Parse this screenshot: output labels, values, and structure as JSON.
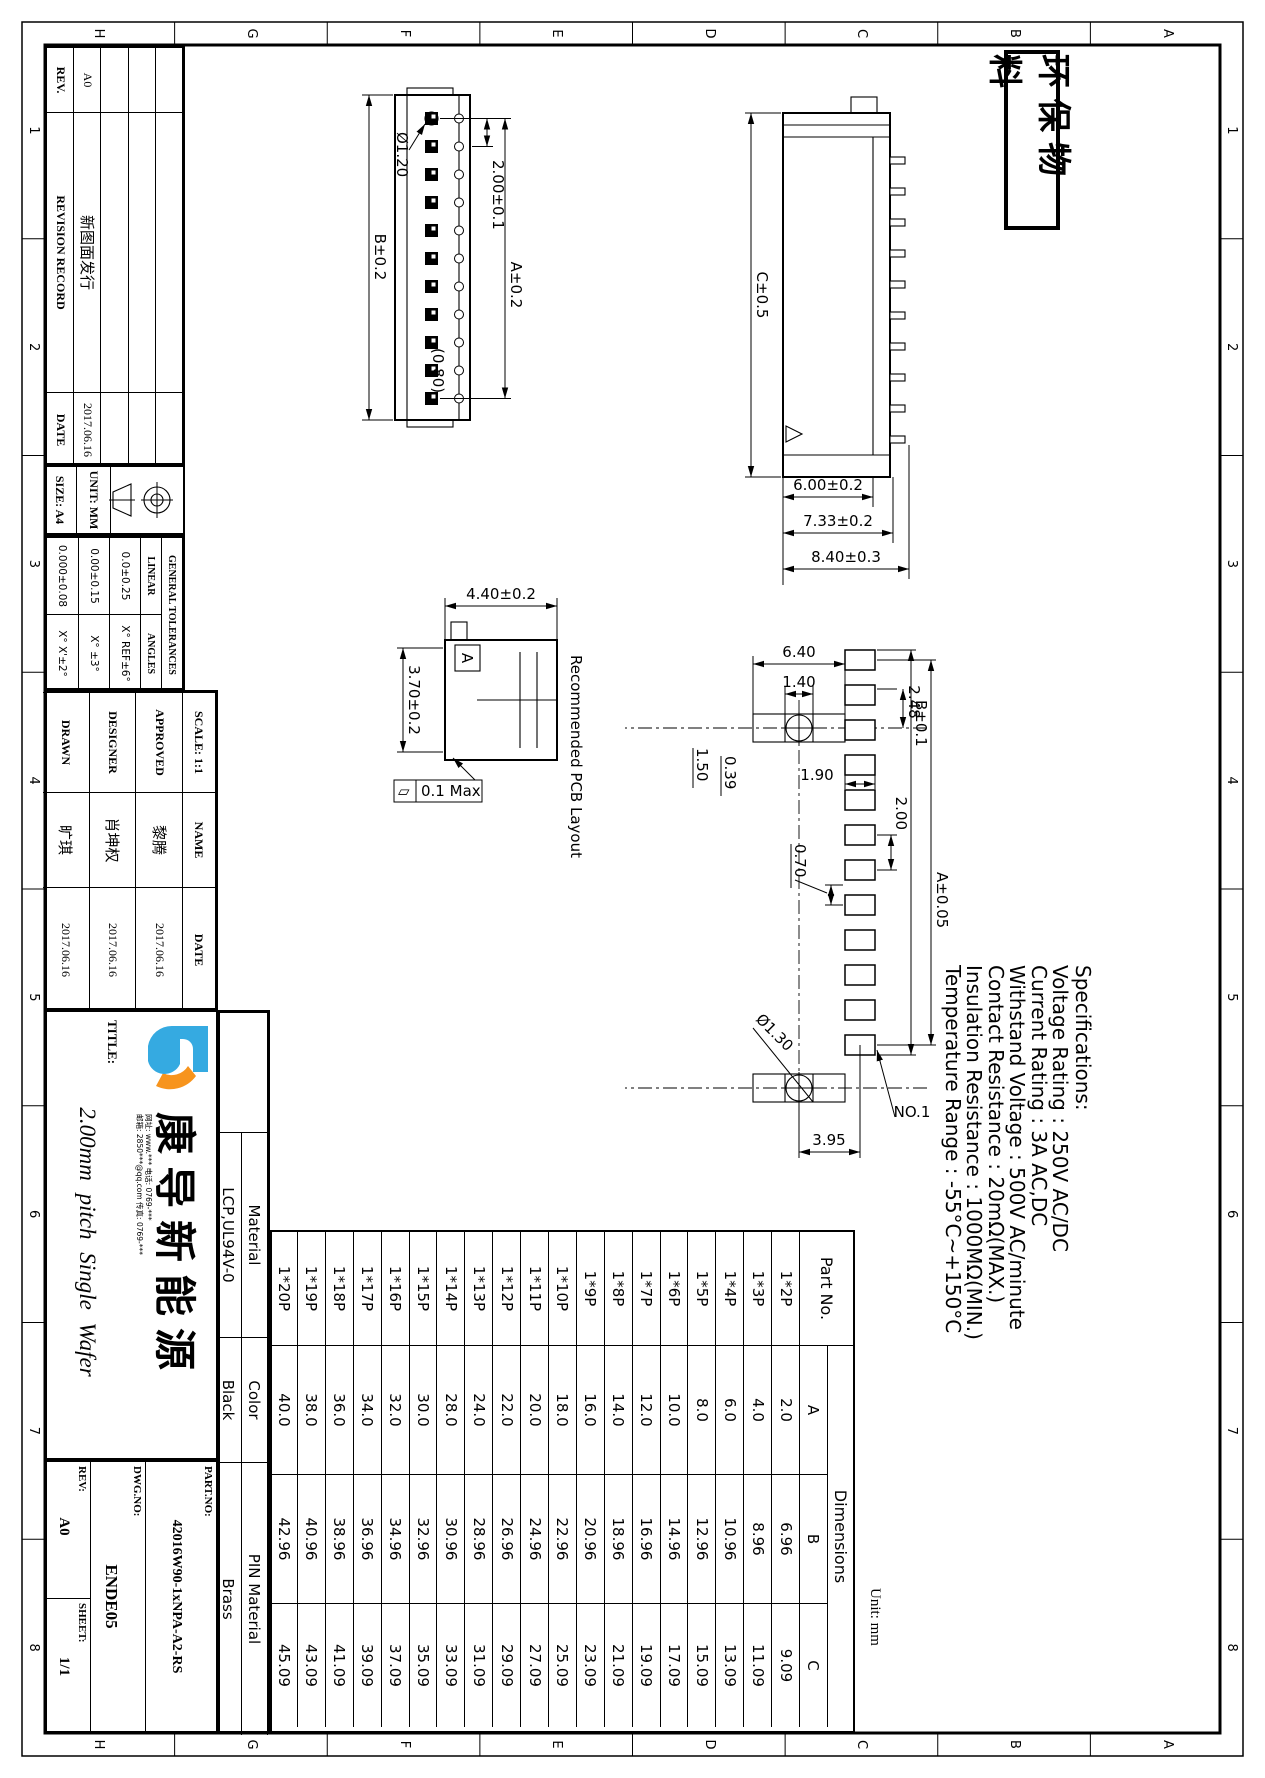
{
  "sheet": {
    "stamp": "环保物料",
    "unit_note": "Unit: mm"
  },
  "grid": {
    "letters": [
      "A",
      "B",
      "C",
      "D",
      "E",
      "F",
      "G",
      "H"
    ],
    "numbers": [
      "1",
      "2",
      "3",
      "4",
      "5",
      "6",
      "7",
      "8"
    ]
  },
  "revision_table": {
    "rev_header": "REV.",
    "record_header": "REVISION RECORD",
    "date_header": "DATE",
    "rows": [
      {
        "rev": "A0",
        "desc": "新图面发行",
        "date": "2017.06.16"
      }
    ]
  },
  "title_block": {
    "size_label": "SIZE: A4",
    "unit_label": "UNIT: MM",
    "tolerances": {
      "title": "GENERAL TOLERANCES",
      "linear_label": "LINEAR",
      "angles_label": "ANGLES",
      "linear": [
        "0.0±0.25",
        "0.00±0.15",
        "0.000±0.08"
      ],
      "angles": [
        "X° REF±6°",
        "X° ±3°",
        "X° X'±2°"
      ]
    },
    "scale_label": "SCALE:",
    "scale_value": "1:1",
    "name_header": "NAME",
    "date_header": "DATE",
    "signoff": [
      {
        "role": "APPROVED",
        "name": "黎腾",
        "date": "2017.06.16"
      },
      {
        "role": "DESIGNER",
        "name": "肖坤权",
        "date": "2017.06.16"
      },
      {
        "role": "DRAWN",
        "name": "旷琪",
        "date": "2017.06.16"
      }
    ],
    "title_label": "TITLE:",
    "title": "2.00mm pitch Single Wafer",
    "company_name": "康导新能源",
    "contact_line1": "网址: www.*** 电话: 0769-***",
    "contact_line2": "邮箱: 2850***@qq.com 传真: 0769-***",
    "material_label": "Material",
    "material": "LCP,UL94V-0",
    "color_label": "Color",
    "color": "Black",
    "pin_material_label": "PIN Material",
    "pin_material": "Brass",
    "part_no_label": "PART.NO:",
    "part_no": "42016W90-1xNPA-A2-RS",
    "dwg_no_label": "DWG.NO:",
    "dwg_no": "ENDE05",
    "rev_label": "REV:",
    "rev": "A0",
    "sheet_label": "SHEET:",
    "sheet": "1/1"
  },
  "specifications": {
    "title": "Specifications:",
    "lines": [
      "Voltage Rating : 250V AC/DC",
      "Current Rating : 3A AC,DC",
      "Withstand Voltage : 500V AC/minute",
      "Contact Resistance : 20mΩ(MAX.)",
      "Insulation Resistance : 1000MΩ(MIN.)",
      "Temperature Range : -55°C~+150°C"
    ]
  },
  "parts_table": {
    "part_no_header": "Part No.",
    "dims_header": "Dimensions",
    "col_a": "A",
    "col_b": "B",
    "col_c": "C",
    "rows": [
      [
        "1*2P",
        "2.0",
        "6.96",
        "9.09"
      ],
      [
        "1*3P",
        "4.0",
        "8.96",
        "11.09"
      ],
      [
        "1*4P",
        "6.0",
        "10.96",
        "13.09"
      ],
      [
        "1*5P",
        "8.0",
        "12.96",
        "15.09"
      ],
      [
        "1*6P",
        "10.0",
        "14.96",
        "17.09"
      ],
      [
        "1*7P",
        "12.0",
        "16.96",
        "19.09"
      ],
      [
        "1*8P",
        "14.0",
        "18.96",
        "21.09"
      ],
      [
        "1*9P",
        "16.0",
        "20.96",
        "23.09"
      ],
      [
        "1*10P",
        "18.0",
        "22.96",
        "25.09"
      ],
      [
        "1*11P",
        "20.0",
        "24.96",
        "27.09"
      ],
      [
        "1*12P",
        "22.0",
        "26.96",
        "29.09"
      ],
      [
        "1*13P",
        "24.0",
        "28.96",
        "31.09"
      ],
      [
        "1*14P",
        "28.0",
        "30.96",
        "33.09"
      ],
      [
        "1*15P",
        "30.0",
        "32.96",
        "35.09"
      ],
      [
        "1*16P",
        "32.0",
        "34.96",
        "37.09"
      ],
      [
        "1*17P",
        "34.0",
        "36.96",
        "39.09"
      ],
      [
        "1*18P",
        "36.0",
        "38.96",
        "41.09"
      ],
      [
        "1*19P",
        "38.0",
        "40.96",
        "43.09"
      ],
      [
        "1*20P",
        "40.0",
        "42.96",
        "45.09"
      ]
    ]
  },
  "drawing": {
    "front_view": {
      "dim_b": "B±0.2",
      "dim_a": "A±0.2",
      "pitch": "2.00±0.1",
      "hole": "Ø1.20",
      "ref": "(0.80)"
    },
    "side_view": {
      "dim_c": "C±0.5",
      "d600": "6.00±0.2",
      "d733": "7.33±0.2",
      "d840": "8.40±0.3"
    },
    "end_view": {
      "height": "4.40±0.2",
      "width": "3.70±0.2",
      "fcf_symbol": "▱",
      "fcf_value": "0.1 Max",
      "section_label": "A"
    },
    "pcb": {
      "title": "Recommended PCB Layout",
      "d640": "6.40",
      "d140": "1.40",
      "d248": "2.48",
      "d150": "1.50",
      "d039": "0.39",
      "d190": "1.90",
      "d200": "2.00",
      "dim_a": "A±0.05",
      "dim_b": "B±0.1",
      "d070": "0.70",
      "hole": "Ø1.30",
      "pin1": "NO.1",
      "d395": "3.95"
    }
  }
}
